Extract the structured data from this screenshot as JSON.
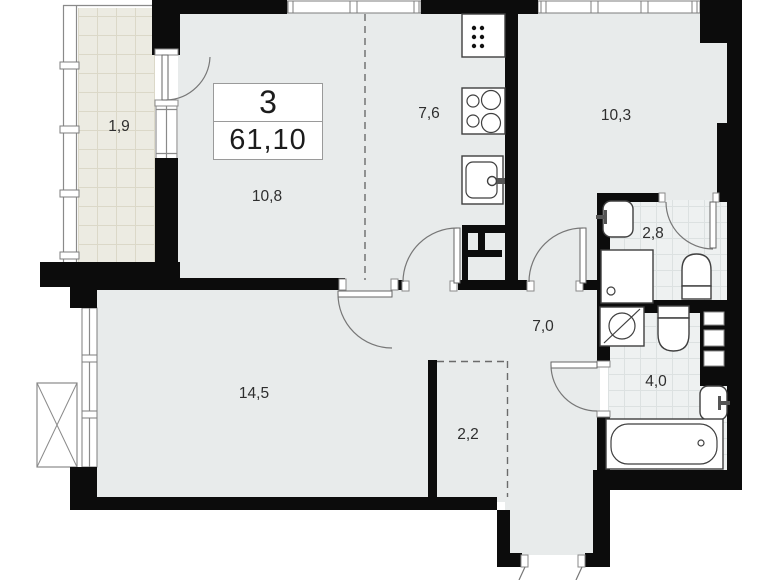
{
  "title_block": {
    "room_count": "3",
    "total_area": "61,10"
  },
  "room_labels": {
    "balcony": "1,9",
    "living_room": "10,8",
    "kitchen": "7,6",
    "bedroom": "10,3",
    "shower_room": "2,8",
    "hallway": "7,0",
    "bedroom_2": "14,5",
    "wardrobe": "2,2",
    "bathroom": "4,0"
  },
  "colors": {
    "wall": "#0c0c0c",
    "floor": "#e8ebeb",
    "balcony_tile": "#ecebe2",
    "bath_tile": "#eef1f1",
    "label_text": "#2e2e2e"
  }
}
